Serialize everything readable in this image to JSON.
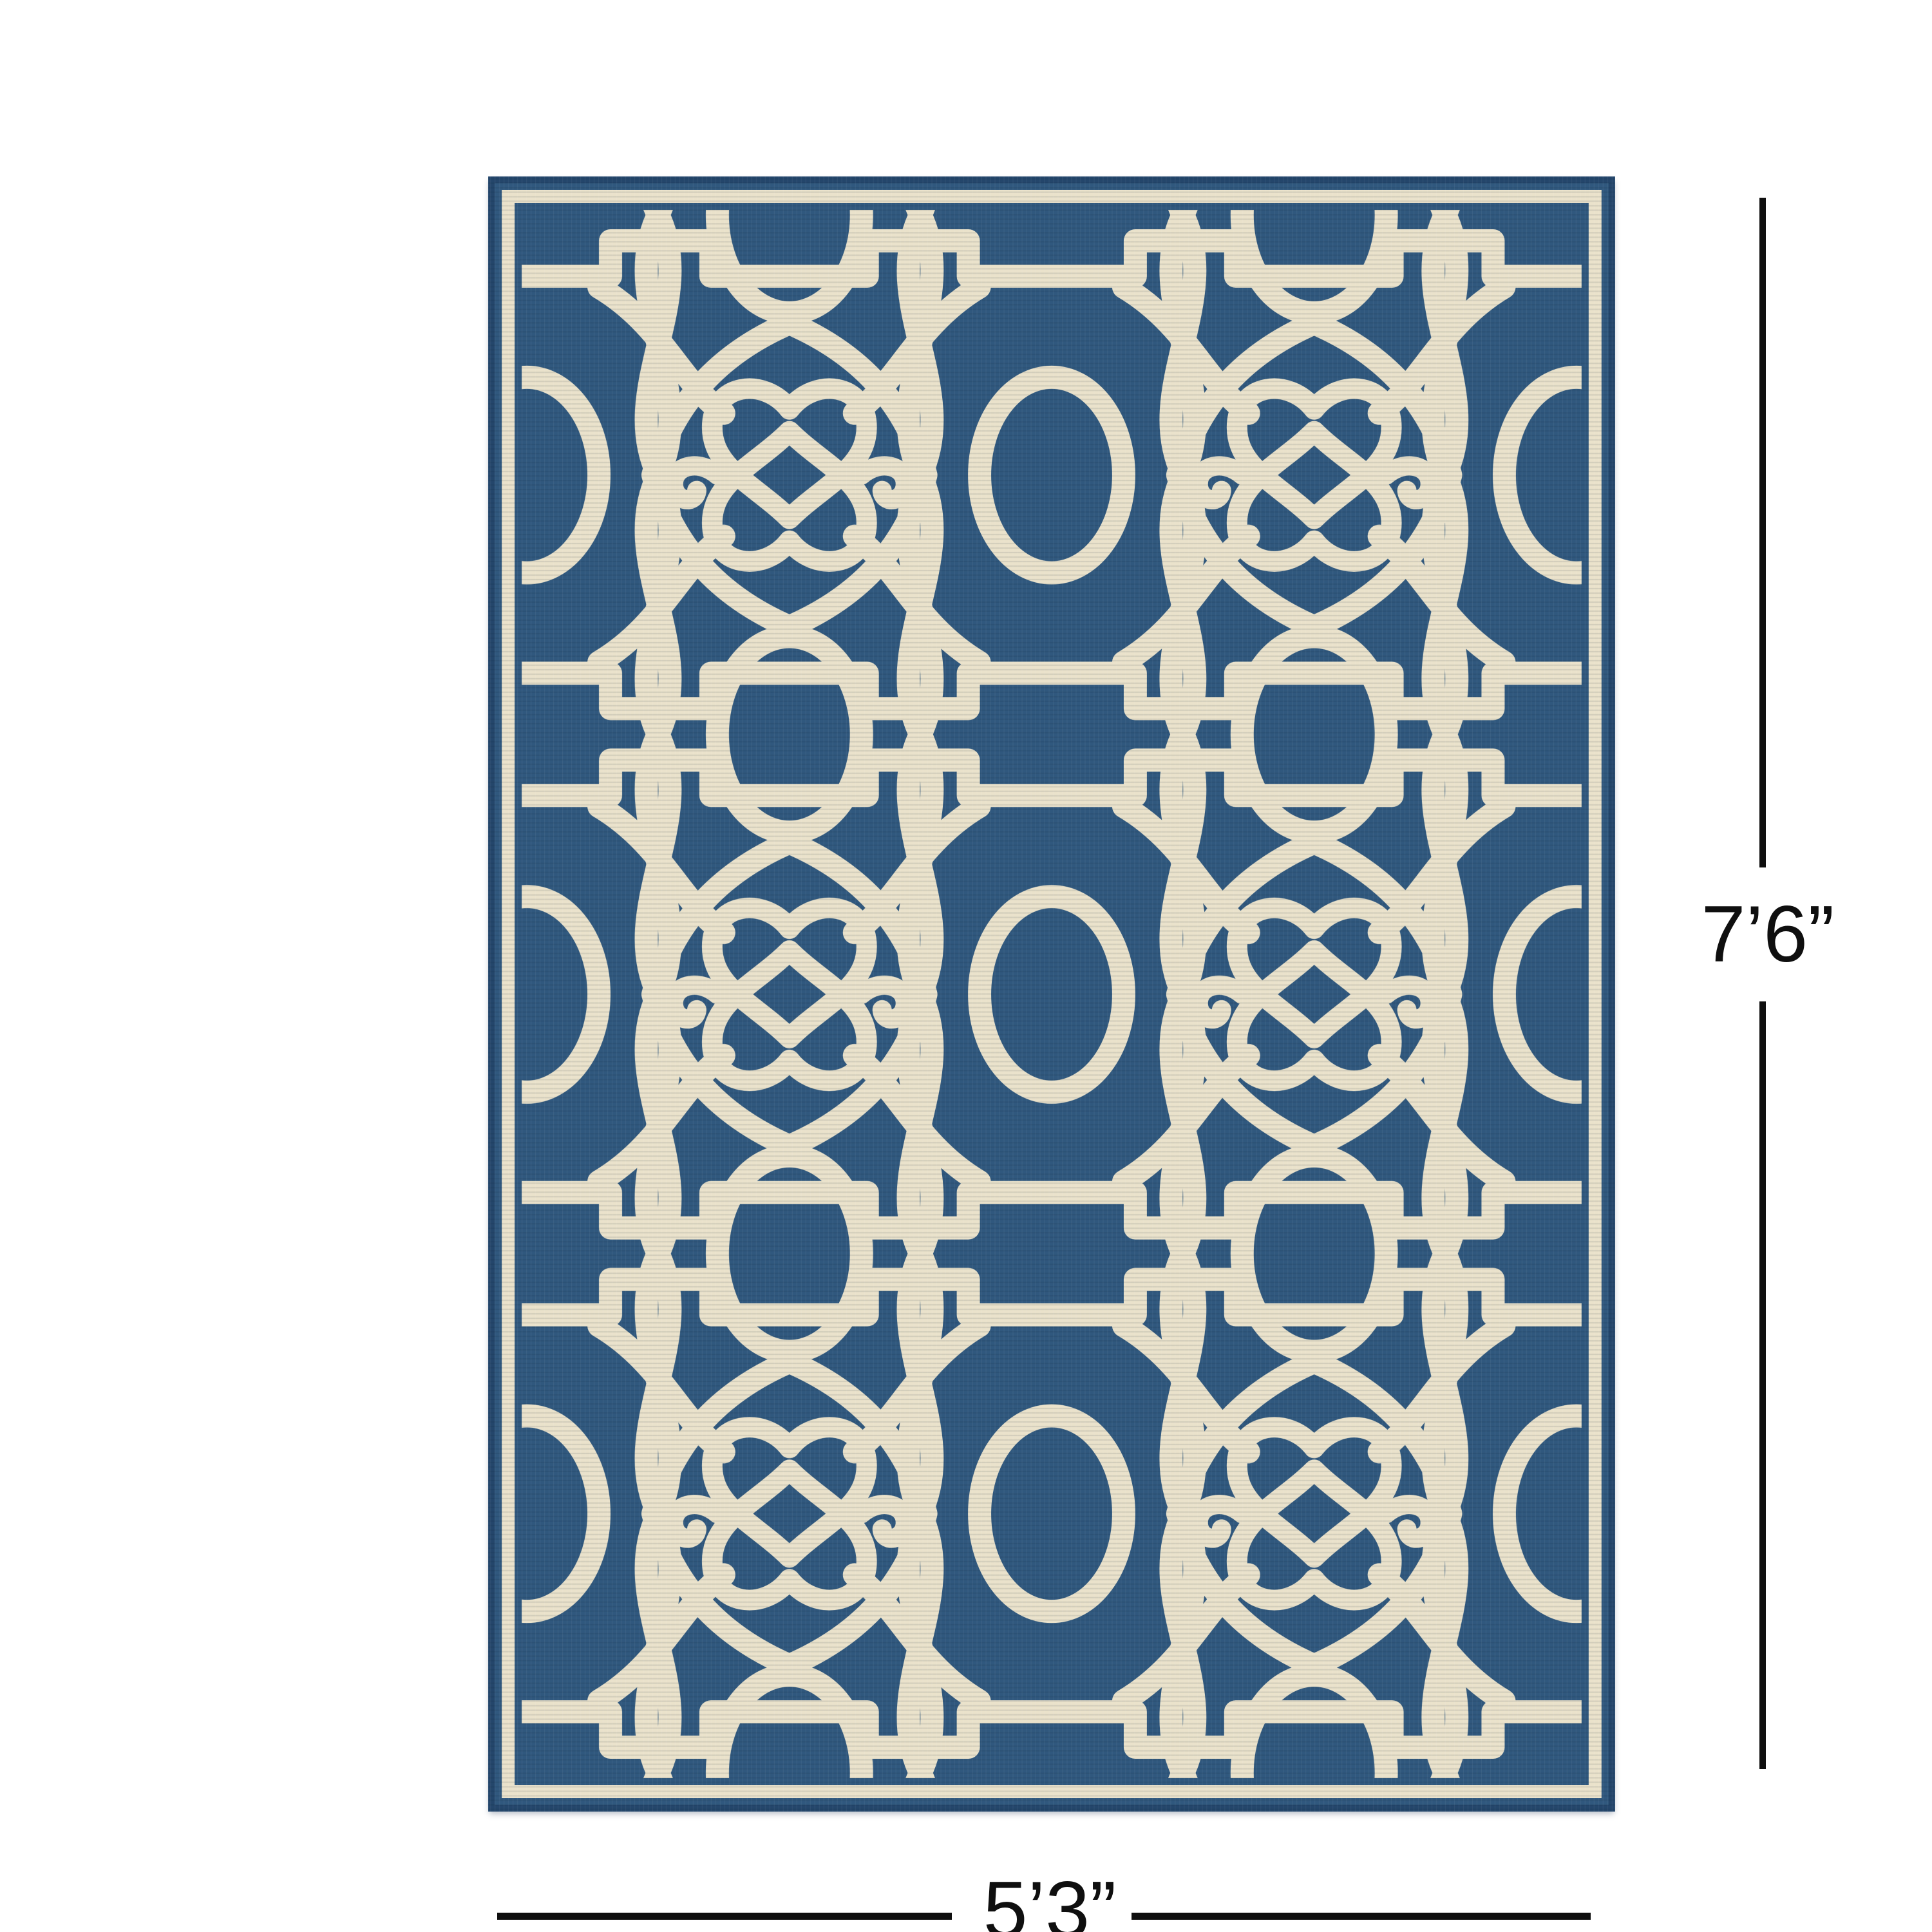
{
  "diagram": {
    "background_color": "#ffffff",
    "dimension_line_color": "#0f0f0f",
    "height_annotation": {
      "label": "7’6”"
    },
    "width_annotation": {
      "label": "5’3”"
    }
  },
  "rug": {
    "colors": {
      "field": "#30587e",
      "pattern": "#eae2cb",
      "border": "#eae2cb",
      "edge": "#24466b"
    }
  }
}
